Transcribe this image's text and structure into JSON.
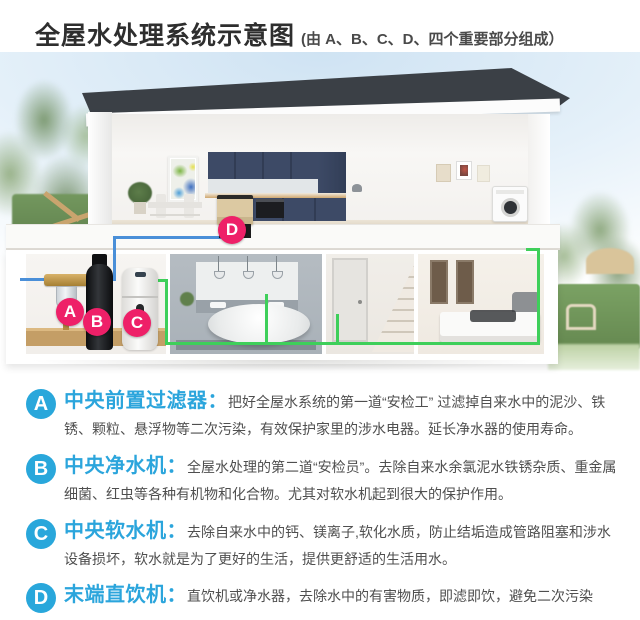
{
  "header": {
    "title": "全屋水处理系统示意图",
    "subtitle": "(由 A、B、C、D、四个重要部分组成）"
  },
  "diagram": {
    "markers": [
      {
        "id": "A",
        "device": "central-pre-filter"
      },
      {
        "id": "B",
        "device": "central-water-purifier"
      },
      {
        "id": "C",
        "device": "central-water-softener"
      },
      {
        "id": "D",
        "device": "terminal-drinking-unit"
      }
    ]
  },
  "sections": [
    {
      "id": "A",
      "heading": "中央前置过滤器：",
      "body": "把好全屋水系统的第一道“安检工” 过滤掉自来水中的泥沙、铁锈、颗粒、悬浮物等二次污染，有效保护家里的涉水电器。延长净水器的使用寿命。"
    },
    {
      "id": "B",
      "heading": "中央净水机：",
      "body": "全屋水处理的第二道“安检员”。去除自来水余氯泥水铁锈杂质、重金属细菌、红虫等各种有机物和化合物。尤其对软水机起到很大的保护作用。"
    },
    {
      "id": "C",
      "heading": "中央软水机：",
      "body": "去除自来水中的钙、镁离子,软化水质，防止结垢造成管路阻塞和涉水设备损坏，软水就是为了更好的生活，提供更舒适的生活用水。"
    },
    {
      "id": "D",
      "heading": "末端直饮机：",
      "body": "直饮机或净水器，去除水中的有害物质，即滤即饮，避免二次污染"
    }
  ],
  "colors": {
    "accent_blue": "#2BA5DC",
    "marker_pink": "#EE2068",
    "pipe_blue": "#4A8FD8",
    "pipe_green": "#3ECF5A",
    "roof": "#3B4046",
    "cabinet_navy": "#3D4A66"
  }
}
